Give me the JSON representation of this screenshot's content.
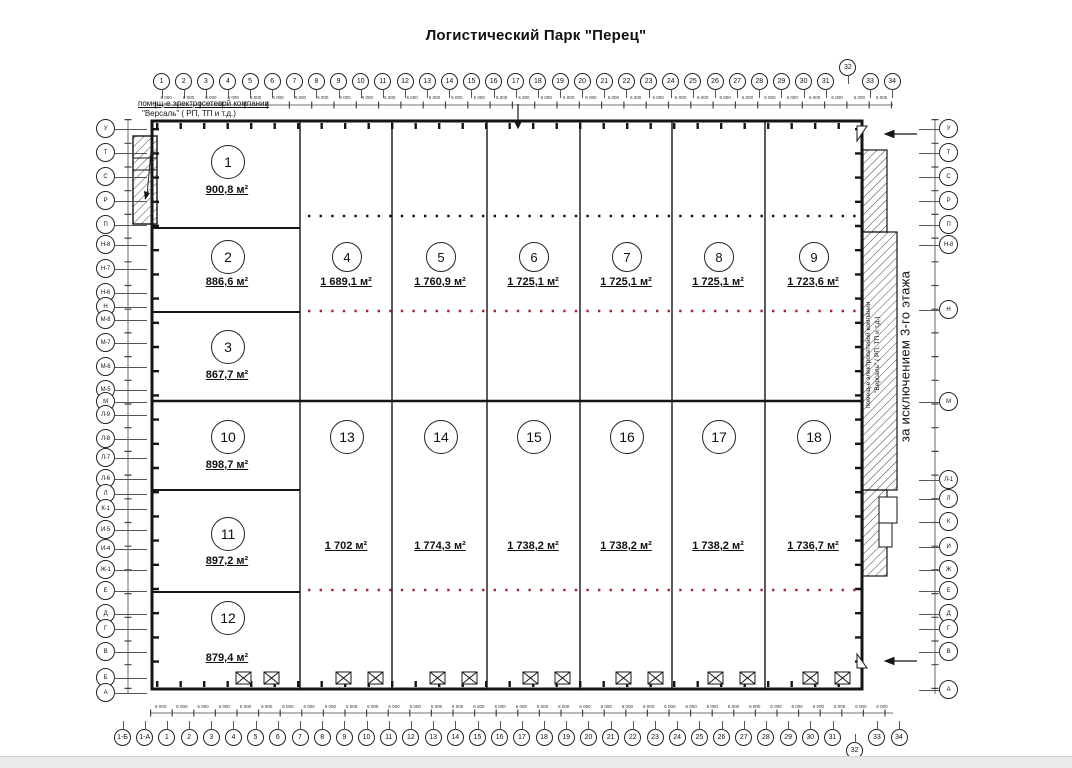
{
  "title": "Логистический Парк \"Перец\"",
  "annotations": {
    "top_left_line1": "помещ-е электросетевой компании",
    "top_left_line2": "\"Версаль\" ( РП, ТП и т.д.)",
    "right_room_line1": "помещ-е электросетевой компании",
    "right_room_line2": "\"Версаль\" ( РП, ТП и т.д.)",
    "right_note": "за исключением 3-го этажа"
  },
  "units": [
    {
      "no": "1",
      "area": "900,8 м²"
    },
    {
      "no": "2",
      "area": "886,6 м²"
    },
    {
      "no": "3",
      "area": "867,7 м²"
    },
    {
      "no": "4",
      "area": "1 689,1 м²"
    },
    {
      "no": "5",
      "area": "1 760,9 м²"
    },
    {
      "no": "6",
      "area": "1 725,1 м²"
    },
    {
      "no": "7",
      "area": "1 725,1 м²"
    },
    {
      "no": "8",
      "area": "1 725,1 м²"
    },
    {
      "no": "9",
      "area": "1 723,6 м²"
    },
    {
      "no": "10",
      "area": "898,7 м²"
    },
    {
      "no": "11",
      "area": "897,2 м²"
    },
    {
      "no": "12",
      "area": "879,4 м²"
    },
    {
      "no": "13",
      "area": "1 702 м²"
    },
    {
      "no": "14",
      "area": "1 774,3 м²"
    },
    {
      "no": "15",
      "area": "1 738,2 м²"
    },
    {
      "no": "16",
      "area": "1 738,2 м²"
    },
    {
      "no": "17",
      "area": "1 738,2 м²"
    },
    {
      "no": "18",
      "area": "1 736,7 м²"
    }
  ],
  "axes": {
    "top": [
      "1",
      "2",
      "3",
      "4",
      "5",
      "6",
      "7",
      "8",
      "9",
      "10",
      "11",
      "12",
      "13",
      "14",
      "15",
      "16",
      "17",
      "18",
      "19",
      "20",
      "21",
      "22",
      "23",
      "24",
      "25",
      "26",
      "27",
      "28",
      "29",
      "30",
      "31",
      "32",
      "33",
      "34"
    ],
    "bottom": [
      "1-Б",
      "1-А",
      "1",
      "2",
      "3",
      "4",
      "5",
      "6",
      "7",
      "8",
      "9",
      "10",
      "11",
      "12",
      "13",
      "14",
      "15",
      "16",
      "17",
      "18",
      "19",
      "20",
      "21",
      "22",
      "23",
      "24",
      "25",
      "26",
      "27",
      "28",
      "29",
      "30",
      "31",
      "32",
      "33",
      "34"
    ],
    "left": [
      "У",
      "Т",
      "С",
      "Р",
      "П",
      "Н-8",
      "Н-7",
      "Н-6",
      "Н",
      "М-8",
      "М-7",
      "М-6",
      "М-5",
      "М",
      "Л-9",
      "Л-8",
      "Л-7",
      "Л-6",
      "Л",
      "К-1",
      "И-5",
      "И-4",
      "Ж-1",
      "Е",
      "Д",
      "Г",
      "В",
      "Б",
      "А"
    ],
    "right": [
      "У",
      "Т",
      "С",
      "Р",
      "П",
      "Н-8",
      "Н",
      "М",
      "Л-1",
      "Л",
      "К",
      "И",
      "Ж",
      "Е",
      "Д",
      "Г",
      "В",
      "А"
    ]
  },
  "dims": {
    "top": [
      "6 000",
      "6 000",
      "6 000",
      "6 000",
      "6 000",
      "6 000",
      "6 000",
      "6 000",
      "6 000",
      "6 000",
      "6 000",
      "6 000",
      "6 000",
      "6 000",
      "6 000",
      "6 000",
      "6 000",
      "6 000",
      "6 000",
      "6 000",
      "6 000",
      "6 000",
      "6 000",
      "6 000",
      "6 000",
      "6 000",
      "6 000",
      "6 000",
      "6 000",
      "6 000",
      "6 000",
      "6 000",
      "6 000"
    ],
    "bottom": [
      "6 000",
      "6 000",
      "6 000",
      "6 000",
      "6 000",
      "6 000",
      "6 000",
      "6 000",
      "6 000",
      "6 000",
      "6 000",
      "6 000",
      "6 000",
      "6 000",
      "6 000",
      "6 000",
      "6 000",
      "6 000",
      "6 000",
      "6 000",
      "6 000",
      "6 000",
      "6 000",
      "6 000",
      "6 000",
      "6 000",
      "6 000",
      "6 000",
      "6 000",
      "6 000",
      "6 000",
      "6 000",
      "6 000",
      "6 000",
      "6 000"
    ]
  },
  "colors": {
    "wall": "#151515",
    "grid_dot_red": "#a82333",
    "hatch": "#444444"
  }
}
